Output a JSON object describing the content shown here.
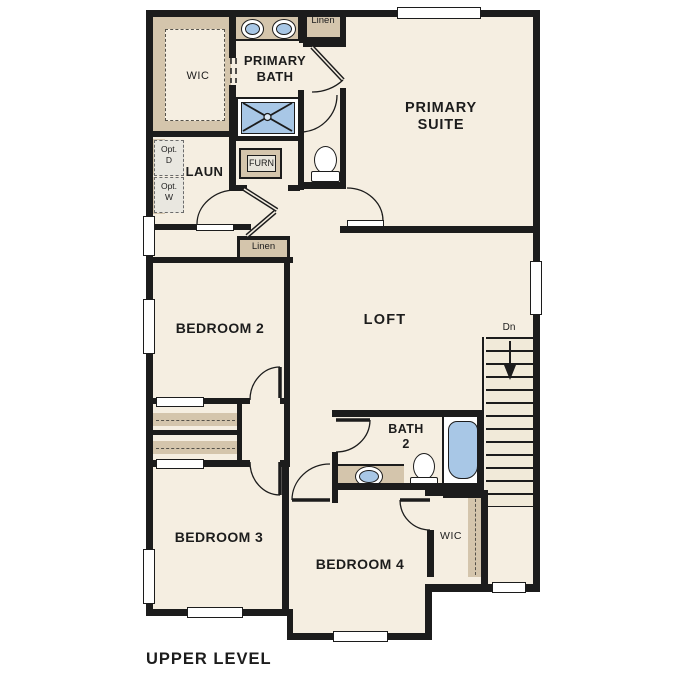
{
  "plan_title": "UPPER LEVEL",
  "rooms": {
    "primary_suite": "PRIMARY\nSUITE",
    "primary_bath": "PRIMARY\nBATH",
    "wic_primary": "WIC",
    "laundry": "LAUN",
    "bedroom_2": "BEDROOM 2",
    "loft": "LOFT",
    "bedroom_3": "BEDROOM 3",
    "bedroom_4": "BEDROOM 4",
    "bath_2": "BATH\n2",
    "wic_bedroom_4": "WIC"
  },
  "closets": {
    "linen_upper": "Linen",
    "linen_hall": "Linen"
  },
  "equipment": {
    "furnace": "FURN",
    "optional_dryer": "Opt.\nD",
    "optional_washer": "Opt.\nW"
  },
  "stairs": {
    "direction": "Dn",
    "icon": "down-arrow-icon"
  },
  "fixtures": {
    "primary_bath": [
      "vanity-sink",
      "vanity-sink",
      "shower",
      "toilet"
    ],
    "bath_2": [
      "vanity-sink",
      "toilet",
      "bathtub"
    ],
    "laundry": [
      "optional-dryer-space",
      "optional-washer-space",
      "furnace"
    ]
  },
  "colors": {
    "background": "#ffffff",
    "floor": "#f5eee1",
    "wall": "#1c1c1c",
    "cabinet_tan": "#d4c5ac",
    "fixture_blue": "#a8c7e6"
  }
}
